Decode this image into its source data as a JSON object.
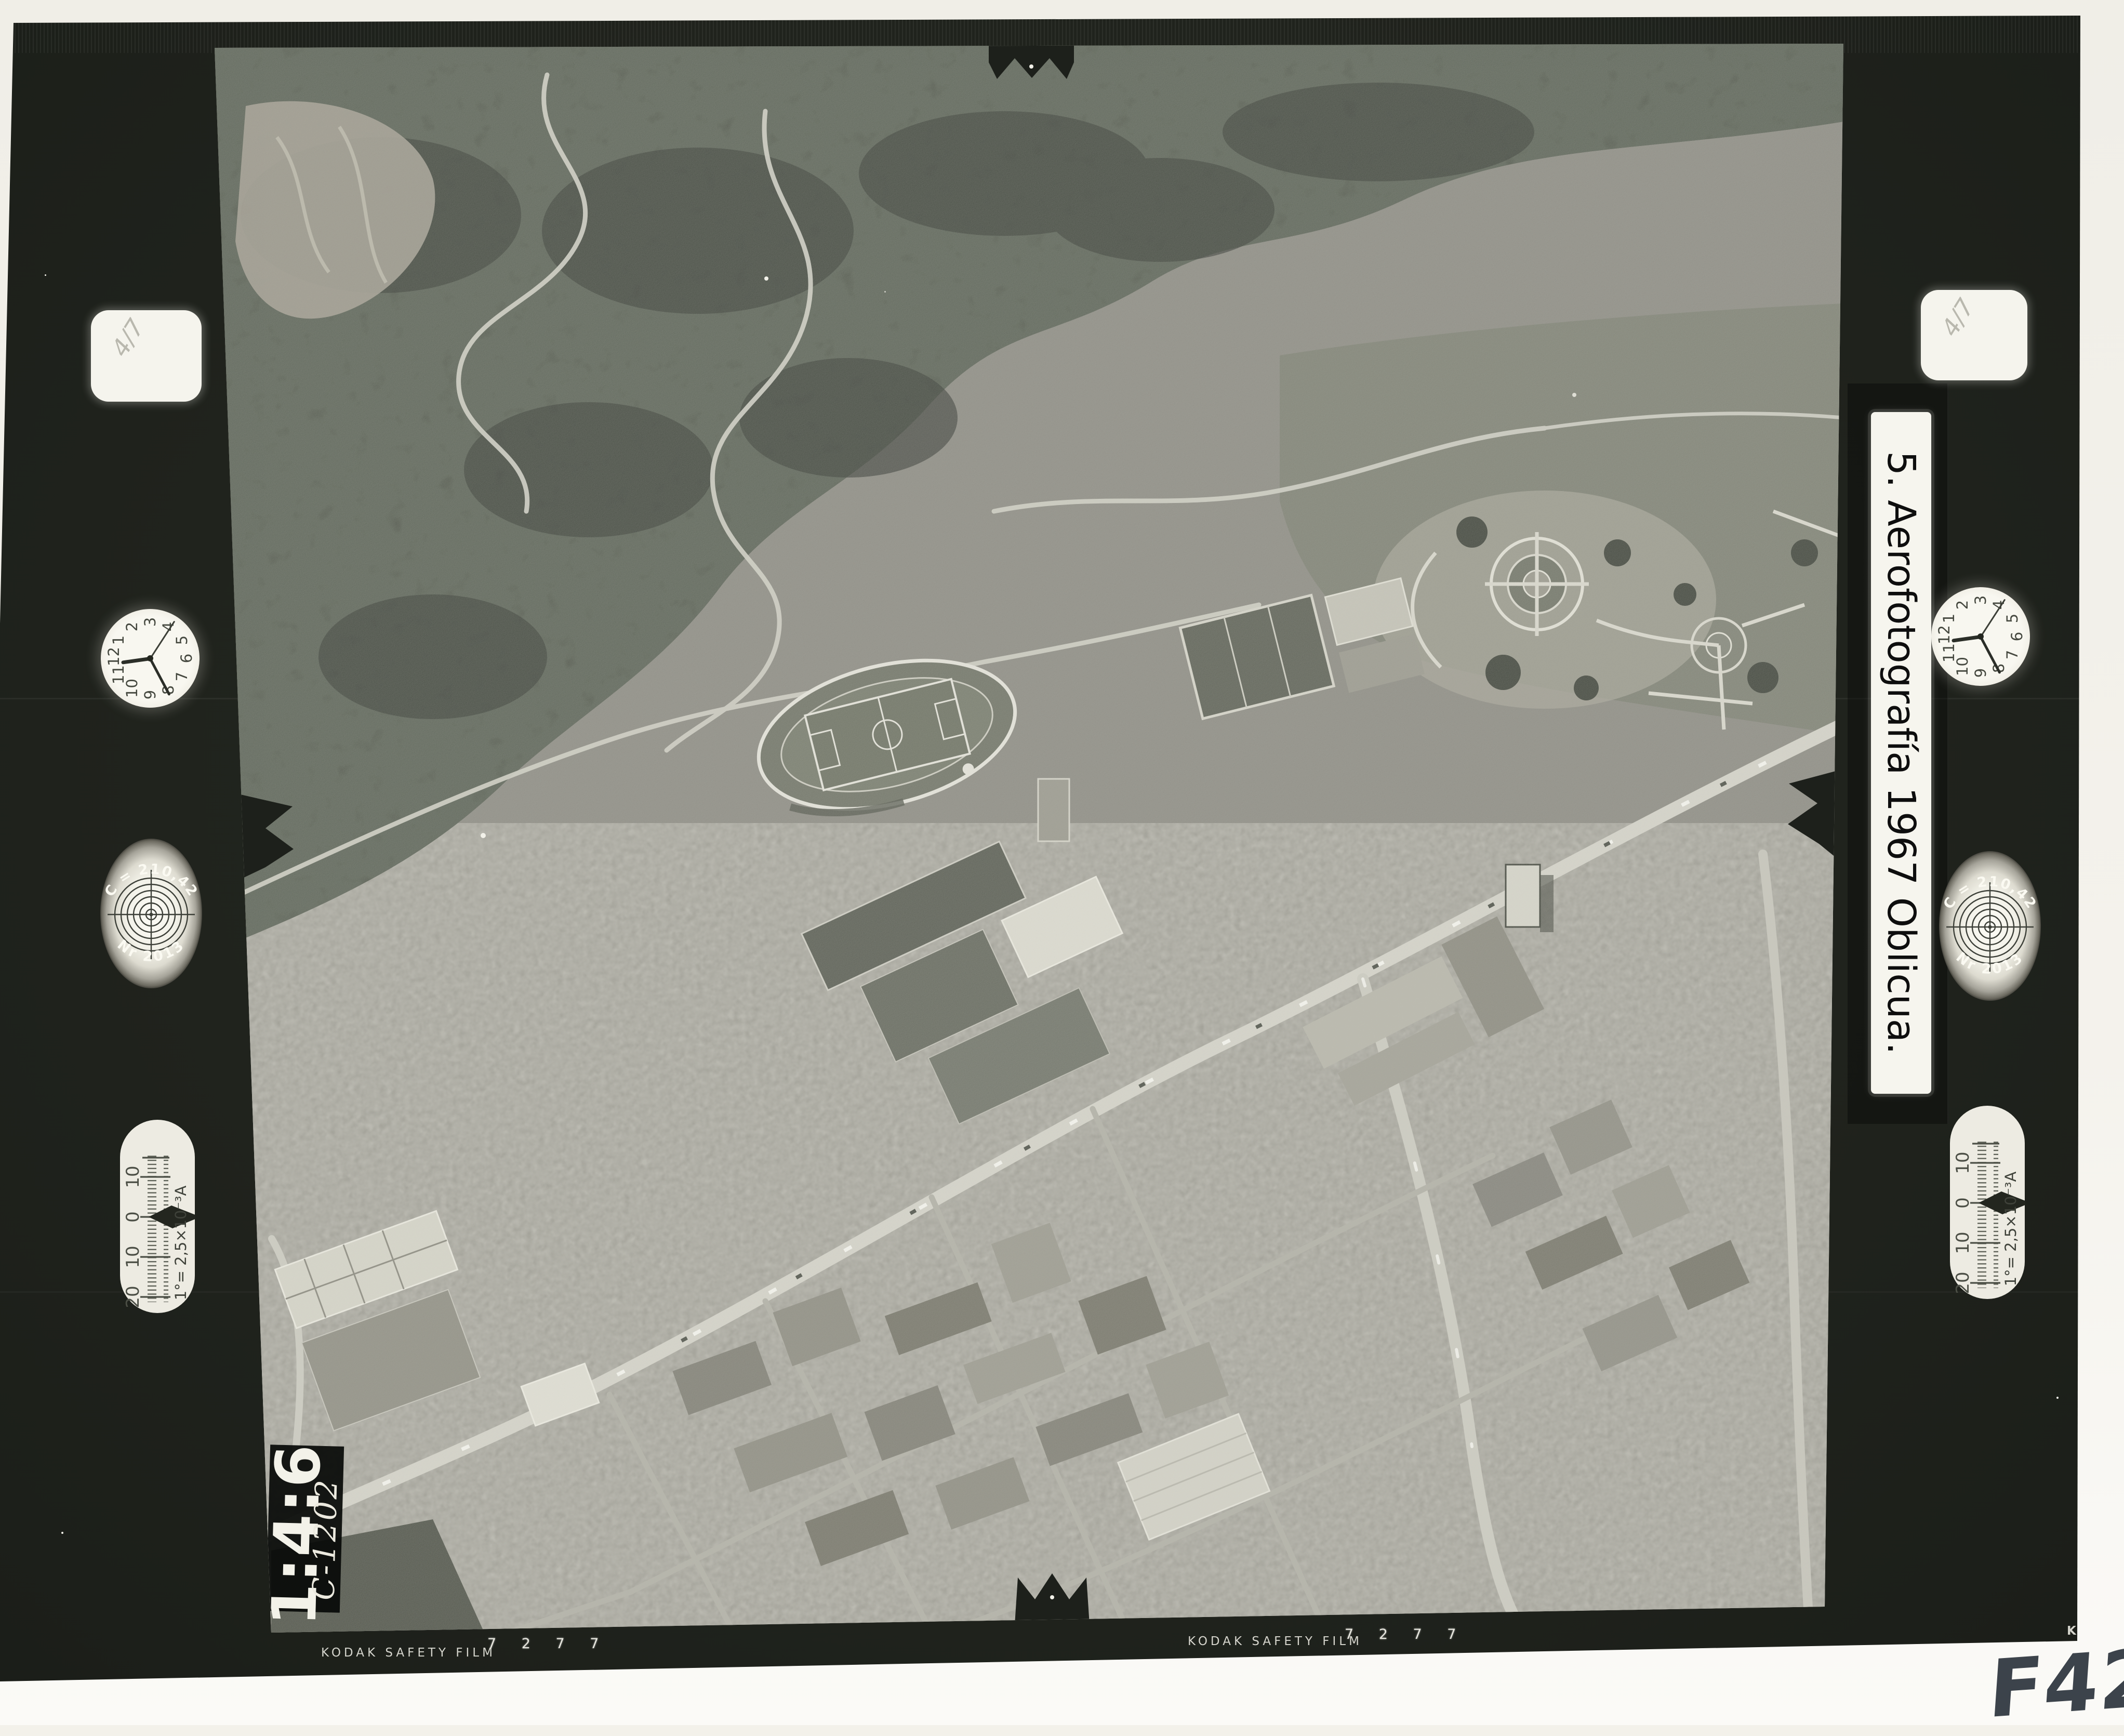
{
  "label_strip": {
    "text": "5. Aerofotografía 1967 Oblicua."
  },
  "film_edge": {
    "kodak_print_left": "KODAK SAFETY FILM",
    "kodak_print_center": "KODAK SAFETY FILM",
    "kodak_print_corner": "KO",
    "frame_ticks_left": "7 2 7 7",
    "frame_ticks_center": "7 2 7 7"
  },
  "frame_id": {
    "printed": "1:4:6",
    "handwritten": "C-1202"
  },
  "annotations": {
    "bottom_right": "F423",
    "square_pencil_left": "4/7",
    "square_pencil_right": "4/7"
  },
  "instruments": {
    "clock_numerals": [
      "12",
      "1",
      "2",
      "3",
      "4",
      "5",
      "6",
      "7",
      "8",
      "9",
      "10",
      "11"
    ],
    "camera_disc": {
      "top": "C = 210,42",
      "bottom": "Nr 2013"
    },
    "tilt_gauge": {
      "labels": [
        "10",
        "0",
        "10",
        "20"
      ],
      "caption": "1°= 2,5×10⁻³A"
    }
  },
  "colors": {
    "film": "#20231d",
    "paper": "#f3f1ea",
    "marker_ink": "#3c434b"
  }
}
